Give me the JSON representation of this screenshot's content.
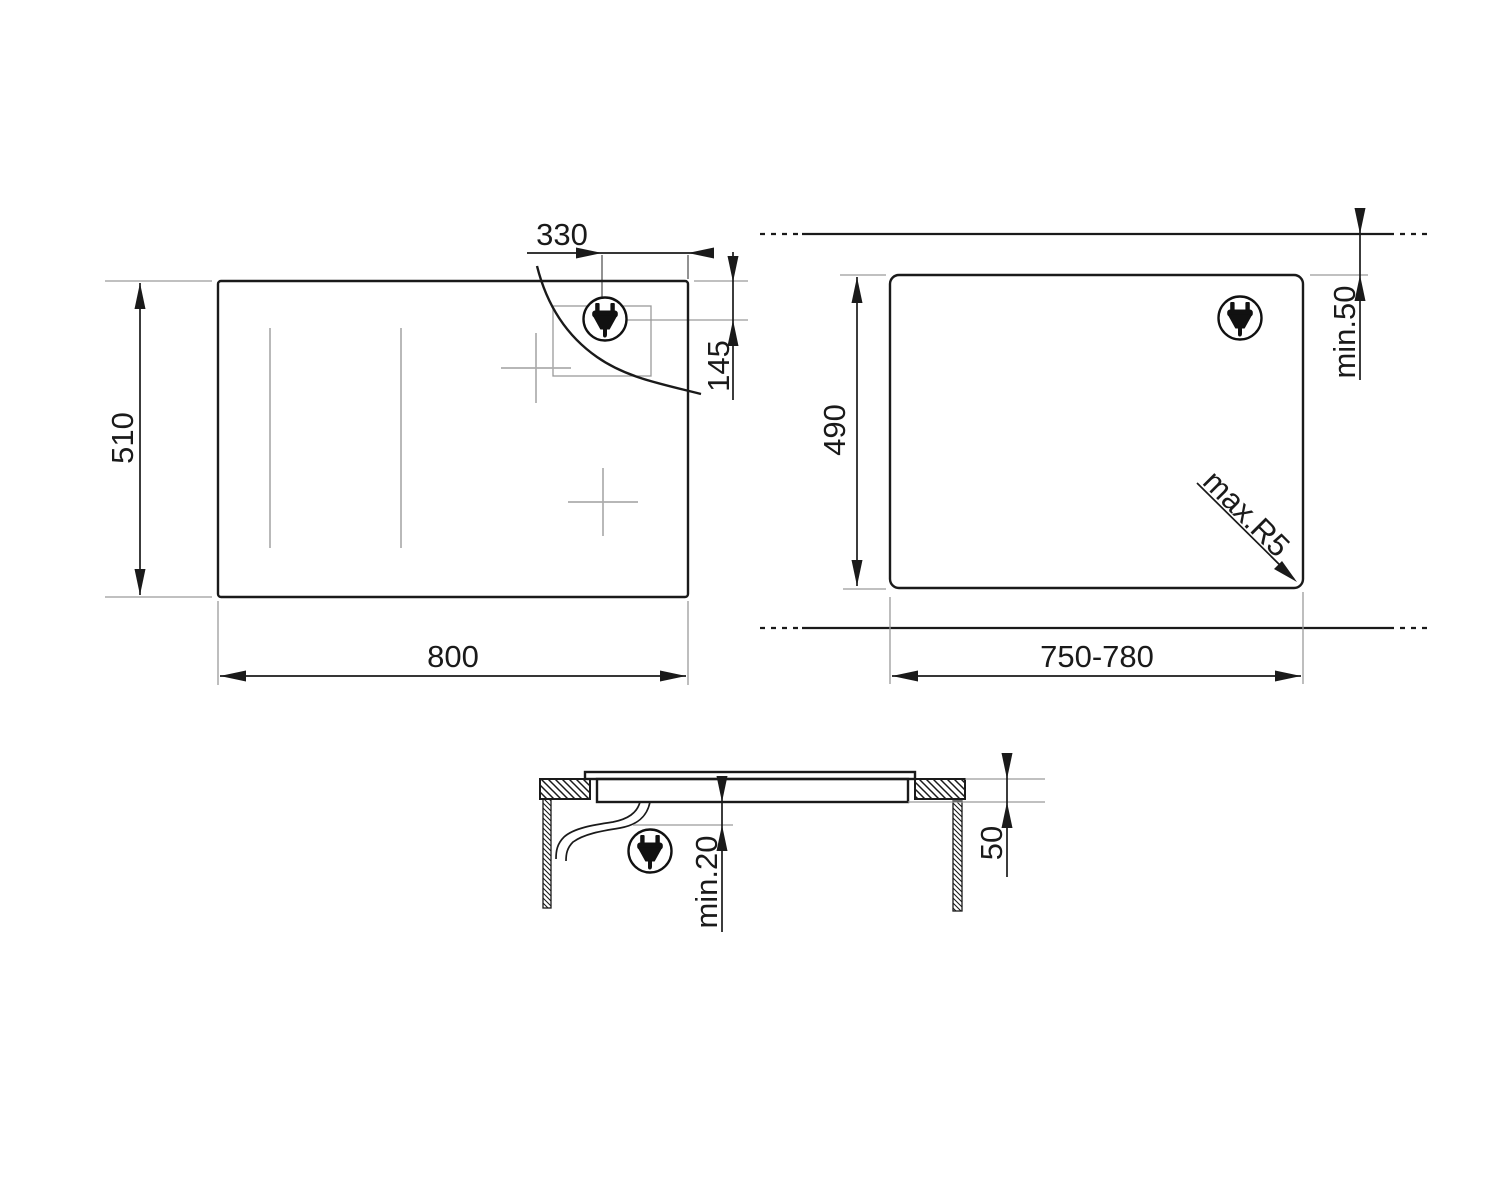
{
  "diagram": {
    "type": "appliance-installation-drawing",
    "subject": "built-in hob with cutout and section views",
    "background": "#ffffff",
    "line_color": "#1a1a1a",
    "reference_line_color": "#9a9a9a",
    "zone_marker_color": "#adadad",
    "views": {
      "plan": {
        "width": "800",
        "height": "510",
        "plug_offset_from_right": "330",
        "plug_offset_from_top": "145"
      },
      "cutout": {
        "width": "750-780",
        "height": "490",
        "rear_clearance": "min.50",
        "corner_radius": "max.R5"
      },
      "section": {
        "clearance_below_hob": "min.20",
        "recess_depth": "50"
      }
    },
    "icons": {
      "plug": "power-plug-icon"
    }
  }
}
